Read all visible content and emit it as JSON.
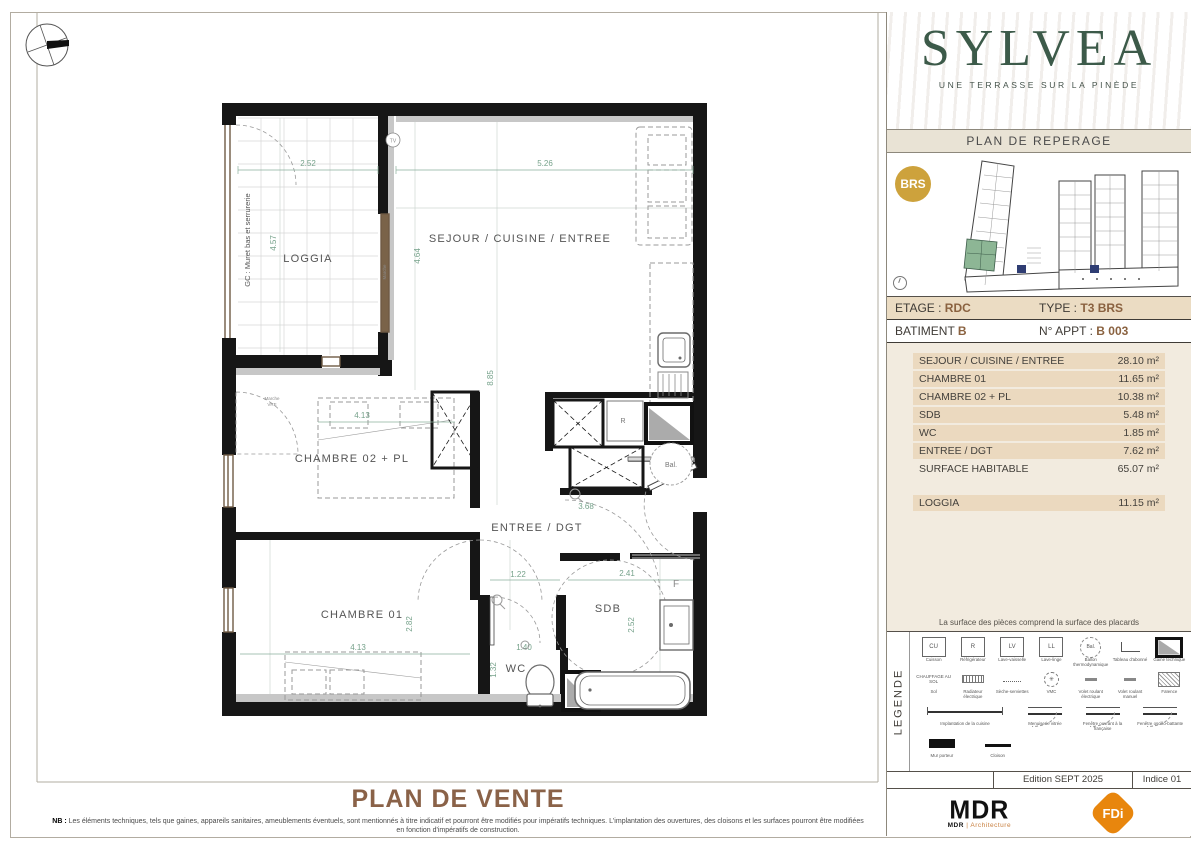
{
  "plan": {
    "labels": {
      "loggia": "LOGGIA",
      "sejour": "SEJOUR / CUISINE / ENTREE",
      "chambre02": "CHAMBRE 02 + PL",
      "entree": "ENTREE / DGT",
      "chambre01": "CHAMBRE 01",
      "sdb": "SDB",
      "wc": "WC",
      "tv": "TV",
      "r": "R",
      "bal": "Bal.",
      "f": "F",
      "gc": "GC : Muret bas et serrurerie",
      "marche_1": "Marche",
      "marche_2": "VRE"
    },
    "dims": {
      "loggia_w": "2.52",
      "loggia_h": "4.57",
      "sejour_w": "5.26",
      "sejour_h1": "4.64",
      "sejour_h2": "8.85",
      "kitchen_w": "3.68",
      "ch2_w": "4.13",
      "entree_w1": "1.22",
      "entree_w2": "2.41",
      "ch1_h": "2.82",
      "ch1_w": "4.13",
      "wc_w": "1.40",
      "wc_h": "1.32",
      "sdb_h": "2.52"
    }
  },
  "bottom": {
    "title": "PLAN DE VENTE",
    "nb_label": "NB :",
    "nb_line1": "Les éléments techniques, tels que gaines, appareils sanitaires, ameublements éventuels, sont mentionnés à titre indicatif et pourront être modifiés pour impératifs techniques. L'implantation des ouvertures, des cloisons et les surfaces pourront être modifiées",
    "nb_line2": "en fonction d'impératifs de construction."
  },
  "sidebar": {
    "brand": {
      "name": "SYLVEA",
      "tagline": "UNE TERRASSE SUR LA PINÈDE",
      "green": "#3c5a49"
    },
    "reperage": {
      "title": "PLAN DE REPERAGE",
      "badge": "BRS",
      "badge_color": "#cda23c",
      "highlight_color": "#8db695"
    },
    "unit": {
      "etage_label": "ETAGE :",
      "etage_value": "RDC",
      "type_label": "TYPE :",
      "type_value": "T3  BRS",
      "batiment_label": "BATIMENT",
      "batiment_value": "B",
      "appt_label": "N° APPT :",
      "appt_value": "B 003",
      "accent_color": "#8a6240"
    },
    "surfaces": {
      "rows": [
        {
          "label": "SEJOUR / CUISINE / ENTREE",
          "value": "28.10 m²"
        },
        {
          "label": "CHAMBRE 01",
          "value": "11.65 m²"
        },
        {
          "label": "CHAMBRE 02 + PL",
          "value": "10.38 m²"
        },
        {
          "label": "SDB",
          "value": "5.48 m²"
        },
        {
          "label": "WC",
          "value": "1.85 m²"
        },
        {
          "label": "ENTREE / DGT",
          "value": "7.62 m²"
        },
        {
          "label": "SURFACE HABITABLE",
          "value": "65.07 m²"
        }
      ],
      "loggia_row": {
        "label": "LOGGIA",
        "value": "11.15 m²"
      },
      "note": "La surface des pièces comprend la surface des placards"
    },
    "legend": {
      "title": "LEGENDE",
      "row1": [
        {
          "sym": "CU",
          "label": "Cuisson"
        },
        {
          "sym": "R",
          "label": "Réfrigérateur"
        },
        {
          "sym": "LV",
          "label": "Lave-vaisselle"
        },
        {
          "sym": "LL",
          "label": "Lave-linge"
        },
        {
          "sym": "Bal.",
          "label": "Ballon thermodynamique"
        },
        {
          "label": "Tableau d'abonné"
        },
        {
          "label": "Gaine technique"
        }
      ],
      "row2": [
        {
          "sym": "CHAUFFAGE AU SOL",
          "label": "Sol"
        },
        {
          "label": "Radiateur électrique"
        },
        {
          "label": "Sèche-serviettes"
        },
        {
          "label": "VMC"
        },
        {
          "label": "Volet roulant électrique"
        },
        {
          "label": "Volet roulant manuel"
        },
        {
          "label": "Faïence"
        }
      ],
      "row3": [
        {
          "label": "Implantation de la cuisine"
        },
        {
          "label": "Menuiserie vitrée"
        },
        {
          "label": "Fenêtre ouvrant à la française"
        },
        {
          "label": "Fenêtre oscillo-battante"
        }
      ],
      "row4": [
        {
          "label": "Mur porteur"
        },
        {
          "label": "Cloison"
        }
      ]
    },
    "footer": {
      "edition": "Edition SEPT 2025",
      "indice": "Indice 01"
    },
    "logos": {
      "mdr_mark": "MDR",
      "mdr_sub_bold": "MDR",
      "mdr_sub_rest": "| Architecture",
      "fdi": "FDi",
      "fdi_color": "#e8860d"
    }
  }
}
